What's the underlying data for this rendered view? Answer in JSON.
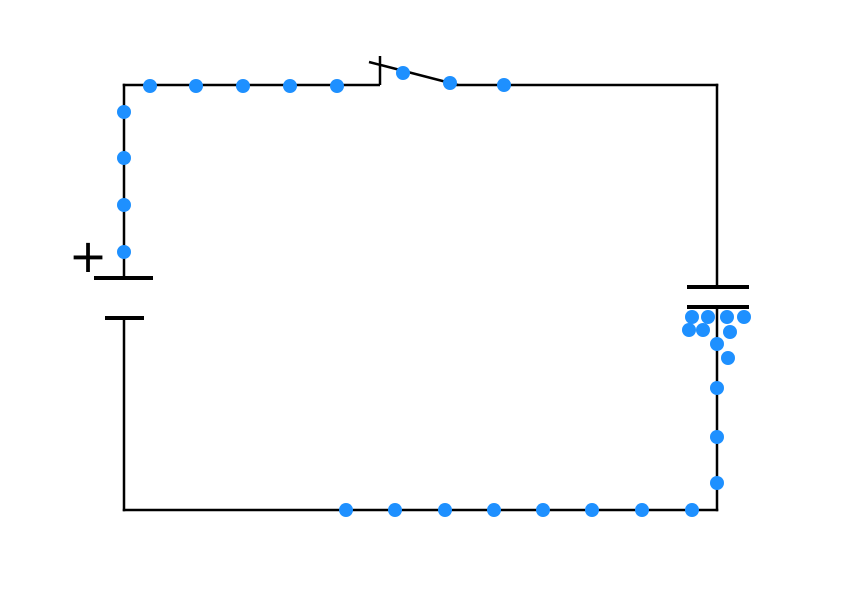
{
  "scene": {
    "width": 842,
    "height": 596,
    "background_color": "#ffffff",
    "description": "Charging-capacitor circuit simulation snapshot: battery, closed knife switch, capacitor, blue electrons flowing"
  },
  "style": {
    "wire_color": "#000000",
    "wire_width": 2.5,
    "plate_color": "#000000",
    "plate_width": 4,
    "switch_width": 2.5,
    "electron_color": "#1E90FF",
    "electron_radius": 7
  },
  "battery": {
    "plus_label": "+",
    "plus_x": 88,
    "plus_y": 256,
    "positive_plate": {
      "x1": 94,
      "y1": 278,
      "x2": 153,
      "y2": 278
    },
    "negative_plate": {
      "x1": 105,
      "y1": 318,
      "x2": 144,
      "y2": 318
    }
  },
  "capacitor": {
    "top_plate": {
      "x1": 687,
      "y1": 287,
      "x2": 749,
      "y2": 287
    },
    "bottom_plate": {
      "x1": 687,
      "y1": 307,
      "x2": 749,
      "y2": 307
    }
  },
  "switch": {
    "state": "closed",
    "post": {
      "x1": 380,
      "y1": 85,
      "x2": 380,
      "y2": 56
    },
    "lever": {
      "x1": 369,
      "y1": 62,
      "x2": 458,
      "y2": 85
    }
  },
  "wires": [
    {
      "name": "wire-top-left",
      "x1": 122.75,
      "y1": 85,
      "x2": 380,
      "y2": 85
    },
    {
      "name": "wire-top-right",
      "x1": 455,
      "y1": 85,
      "x2": 718.25,
      "y2": 85
    },
    {
      "name": "wire-left-upper",
      "x1": 124,
      "y1": 83.75,
      "x2": 124,
      "y2": 277
    },
    {
      "name": "wire-left-lower",
      "x1": 124,
      "y1": 318,
      "x2": 124,
      "y2": 511.25
    },
    {
      "name": "wire-right-upper",
      "x1": 717,
      "y1": 83.75,
      "x2": 717,
      "y2": 286
    },
    {
      "name": "wire-right-lower",
      "x1": 717,
      "y1": 308,
      "x2": 717,
      "y2": 511.25
    },
    {
      "name": "wire-bottom",
      "x1": 122.75,
      "y1": 510,
      "x2": 718.25,
      "y2": 510
    }
  ],
  "electrons": [
    {
      "x": 150,
      "y": 86
    },
    {
      "x": 196,
      "y": 86
    },
    {
      "x": 243,
      "y": 86
    },
    {
      "x": 290,
      "y": 86
    },
    {
      "x": 337,
      "y": 86
    },
    {
      "x": 403,
      "y": 73
    },
    {
      "x": 450,
      "y": 83
    },
    {
      "x": 504,
      "y": 85
    },
    {
      "x": 124,
      "y": 112
    },
    {
      "x": 124,
      "y": 158
    },
    {
      "x": 124,
      "y": 205
    },
    {
      "x": 124,
      "y": 252
    },
    {
      "x": 346,
      "y": 510
    },
    {
      "x": 395,
      "y": 510
    },
    {
      "x": 445,
      "y": 510
    },
    {
      "x": 494,
      "y": 510
    },
    {
      "x": 543,
      "y": 510
    },
    {
      "x": 592,
      "y": 510
    },
    {
      "x": 642,
      "y": 510
    },
    {
      "x": 692,
      "y": 510
    },
    {
      "x": 717,
      "y": 483
    },
    {
      "x": 717,
      "y": 437
    },
    {
      "x": 717,
      "y": 388
    },
    {
      "x": 692,
      "y": 317
    },
    {
      "x": 708,
      "y": 317
    },
    {
      "x": 727,
      "y": 317
    },
    {
      "x": 744,
      "y": 317
    },
    {
      "x": 689,
      "y": 330
    },
    {
      "x": 703,
      "y": 330
    },
    {
      "x": 730,
      "y": 332
    },
    {
      "x": 717,
      "y": 344
    },
    {
      "x": 728,
      "y": 358
    }
  ]
}
